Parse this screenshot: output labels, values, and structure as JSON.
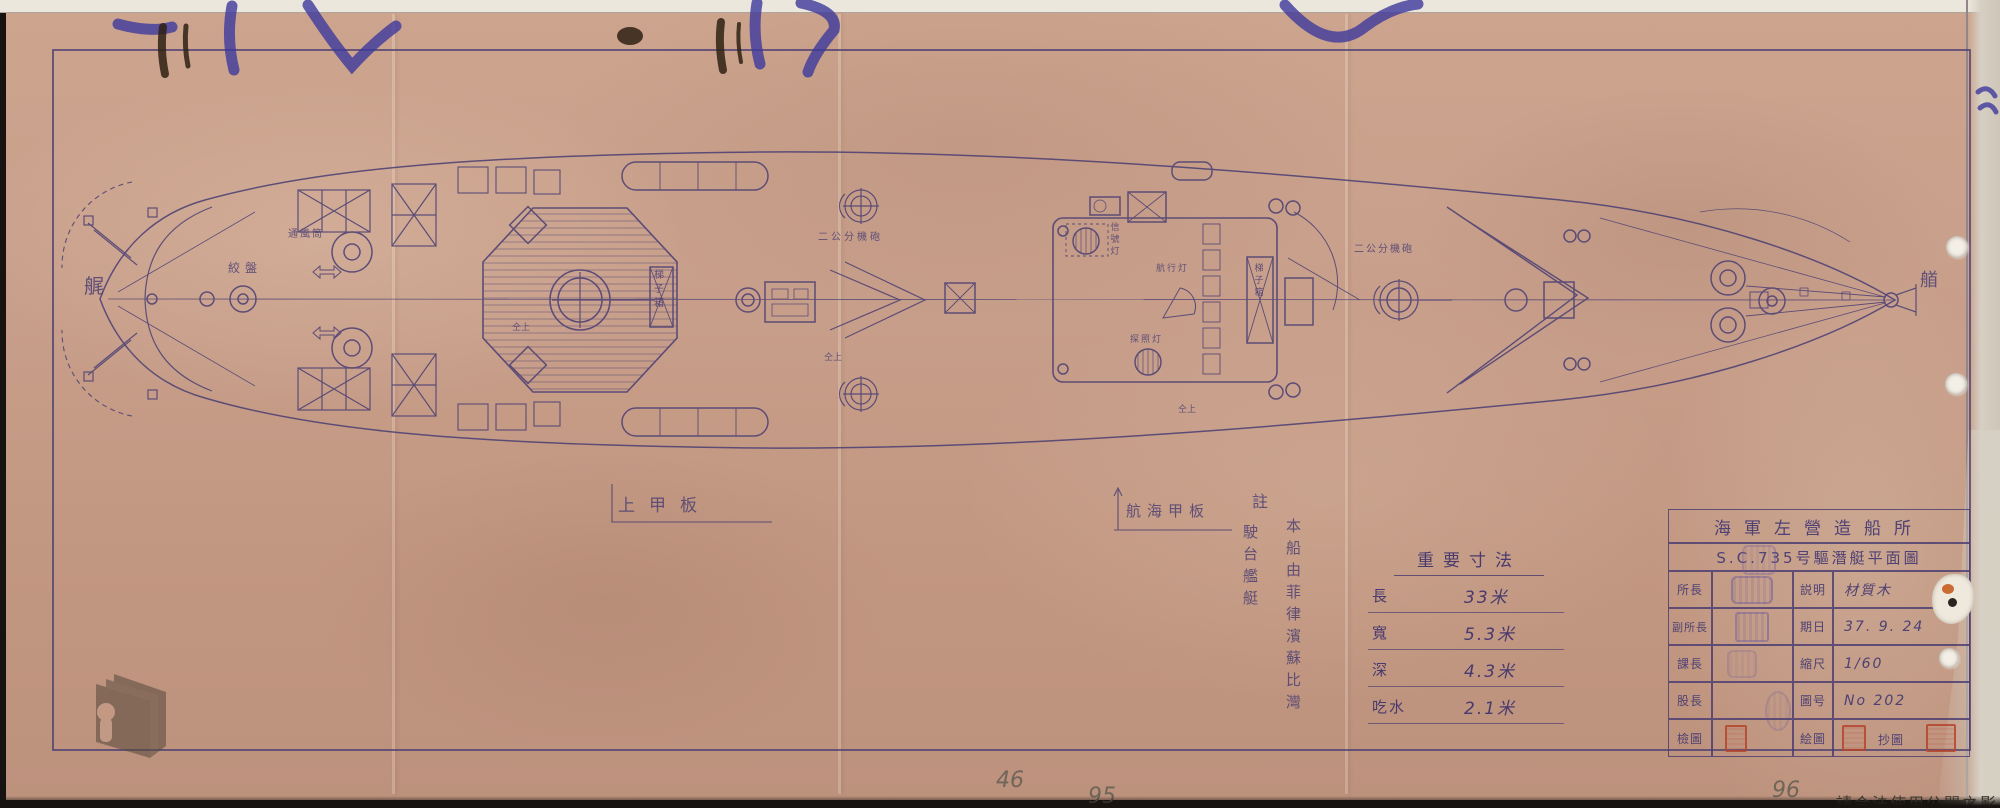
{
  "drawing": {
    "hull_labels": {
      "stern": "艉",
      "bow": "艏"
    },
    "deck_labels": {
      "upper_deck": "上甲板",
      "navigation_deck": "航海甲板"
    },
    "equipment_labels": [
      {
        "text": "絞盤"
      },
      {
        "text": "通風筒"
      },
      {
        "text": "梯子箱"
      },
      {
        "text": "二公分機砲"
      },
      {
        "text": "信號灯"
      },
      {
        "text": "航行灯"
      },
      {
        "text": "探照灯"
      },
      {
        "text": "梯子箱"
      },
      {
        "text": "二公分機砲"
      },
      {
        "text": "仝上"
      },
      {
        "text": "仝上"
      },
      {
        "text": "仝上"
      }
    ]
  },
  "note": {
    "heading": "註",
    "lines": [
      "本船由菲律濱蘇比灣",
      "駛台艦艇"
    ]
  },
  "dimensions_table": {
    "title": "重要寸法",
    "rows": [
      {
        "label": "長",
        "value": "33米"
      },
      {
        "label": "寬",
        "value": "5.3米"
      },
      {
        "label": "深",
        "value": "4.3米"
      },
      {
        "label": "吃水",
        "value": "2.1米"
      }
    ]
  },
  "title_block": {
    "organization": "海軍左營造船所",
    "drawing_title": "S.C.735号驅潛艇平面圖",
    "rows": [
      {
        "c1": "所長",
        "c3": "説明",
        "c4": "材質木"
      },
      {
        "c1": "副所長",
        "c3": "期日",
        "c4": "37. 9. 24"
      },
      {
        "c1": "課長",
        "c3": "縮尺",
        "c4": "1/60"
      },
      {
        "c1": "股長",
        "c3": "圖号",
        "c4": "No 202"
      },
      {
        "c1": "檢圖",
        "c3": "絵圖",
        "c4": "抄圖"
      }
    ]
  },
  "handwritten_numbers": [
    "46",
    "95",
    "96"
  ],
  "watermark": {
    "usage_text": "請合法使用公開之影像"
  },
  "colors": {
    "paper": "#c79e8a",
    "ink": "#4e4173",
    "blue_pen": "#3e3a9d",
    "seal_red": "#b5452c",
    "pencil": "#6f6558"
  }
}
